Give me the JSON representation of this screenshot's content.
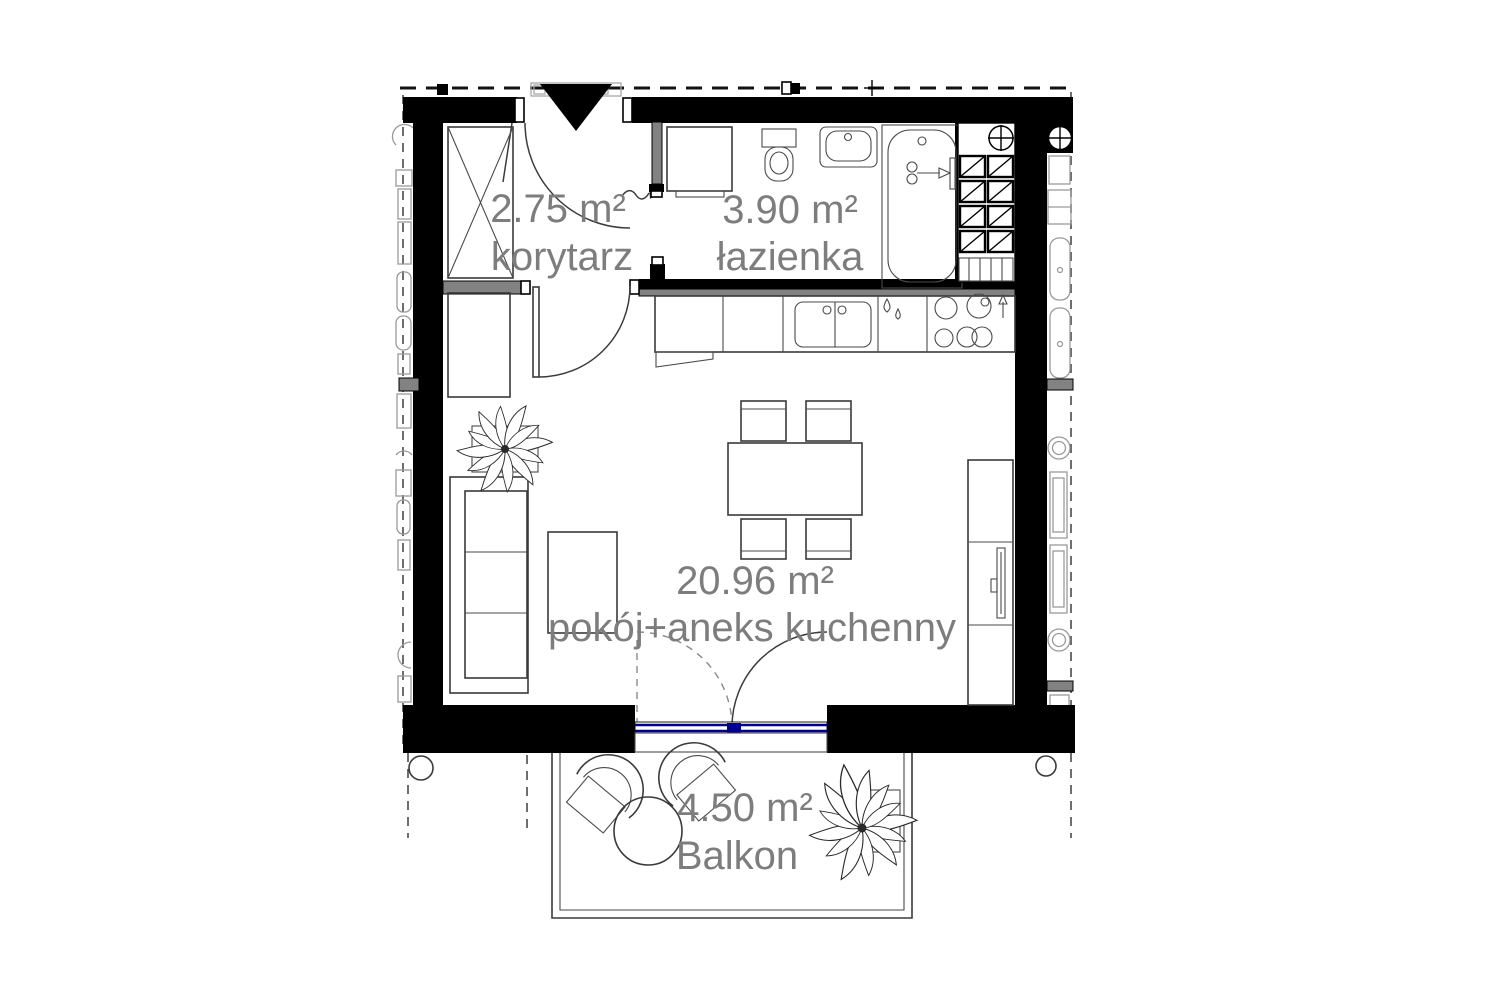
{
  "plan": {
    "title": "apartment-floor-plan",
    "rooms": [
      {
        "id": "korytarz",
        "area": "2.75 m²",
        "name": "korytarz"
      },
      {
        "id": "lazienka",
        "area": "3.90 m²",
        "name": "łazienka"
      },
      {
        "id": "pokoj-aneks",
        "area": "20.96 m²",
        "name": "pokój+aneks kuchenny"
      },
      {
        "id": "balkon",
        "area": "4.50 m²",
        "name": "Balkon"
      }
    ]
  },
  "colors": {
    "wall": "#000000",
    "label": "#7d7d7d",
    "window": "#00008b",
    "beam": "#828282",
    "paper": "#ffffff"
  }
}
